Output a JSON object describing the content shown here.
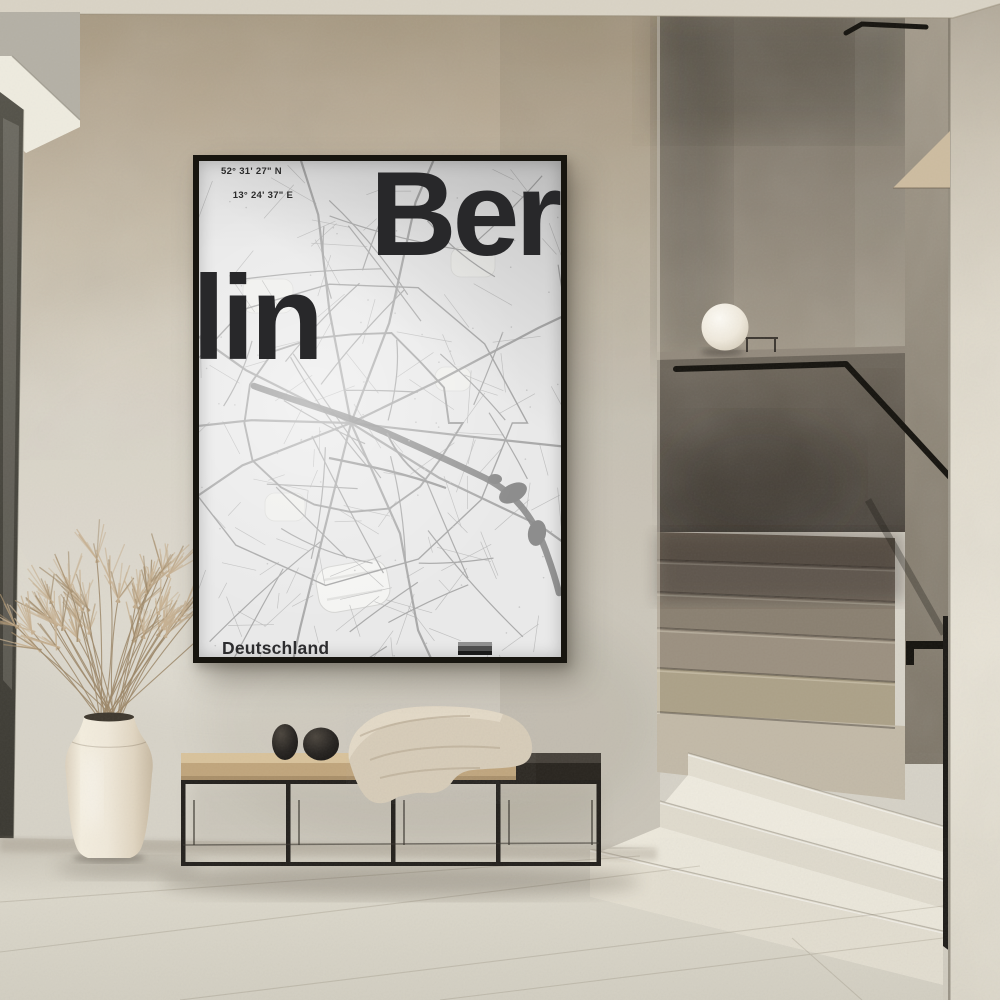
{
  "scene": {
    "type": "interior-photograph",
    "description": "Minimal beige hallway: framed Berlin city-map poster on plaster wall above a black steel bench with wooden top, two black pebble sculptures and a waffle throw blanket, cream ceramic vase with dried pampas grass, glass sphere lamp on stair parapet ledge, terrazzo stairs with black handrail, dark door edge at left",
    "palette": {
      "wall": "#d4d0c5",
      "wall_upper": "#b0a28b",
      "ceiling": "#d9d3c6",
      "floor": "#d6d2c7",
      "stairs_light": "#e8e3d6",
      "stairs_dark": "#6b6154",
      "metal_black": "#1c1a16",
      "wood": "#cdb48d",
      "ceramic": "#ece5d7",
      "pampas": "#b89f7f"
    }
  },
  "poster": {
    "frame_color": "#17150f",
    "map_background": "#e9e9e9",
    "road_color": "#a6a6a6",
    "water_color": "#8d8d8d",
    "text_color": "#28282a",
    "coordinates": {
      "line1": "52° 31' 27\" N",
      "line2": "13° 24' 37\" E"
    },
    "title": {
      "line1": "Ber",
      "line2": "lin",
      "full_word": "Berlin"
    },
    "country_label": "Deutschland",
    "flag_colors": [
      "#909090",
      "#4e4e4e",
      "#1a1a1a"
    ]
  },
  "objects": {
    "lamp": "white sphere table lamp on ledge",
    "bench": "black steel frame bench, wood top left, dark top right",
    "blanket": "beige waffle-knit throw",
    "sculptures": "two black pebble objects",
    "vase": "cream ceramic urn vase",
    "plant": "dried pampas grass",
    "stairs": "terrazzo steps, cream lower, brown upper",
    "handrail": "black metal handrail"
  }
}
